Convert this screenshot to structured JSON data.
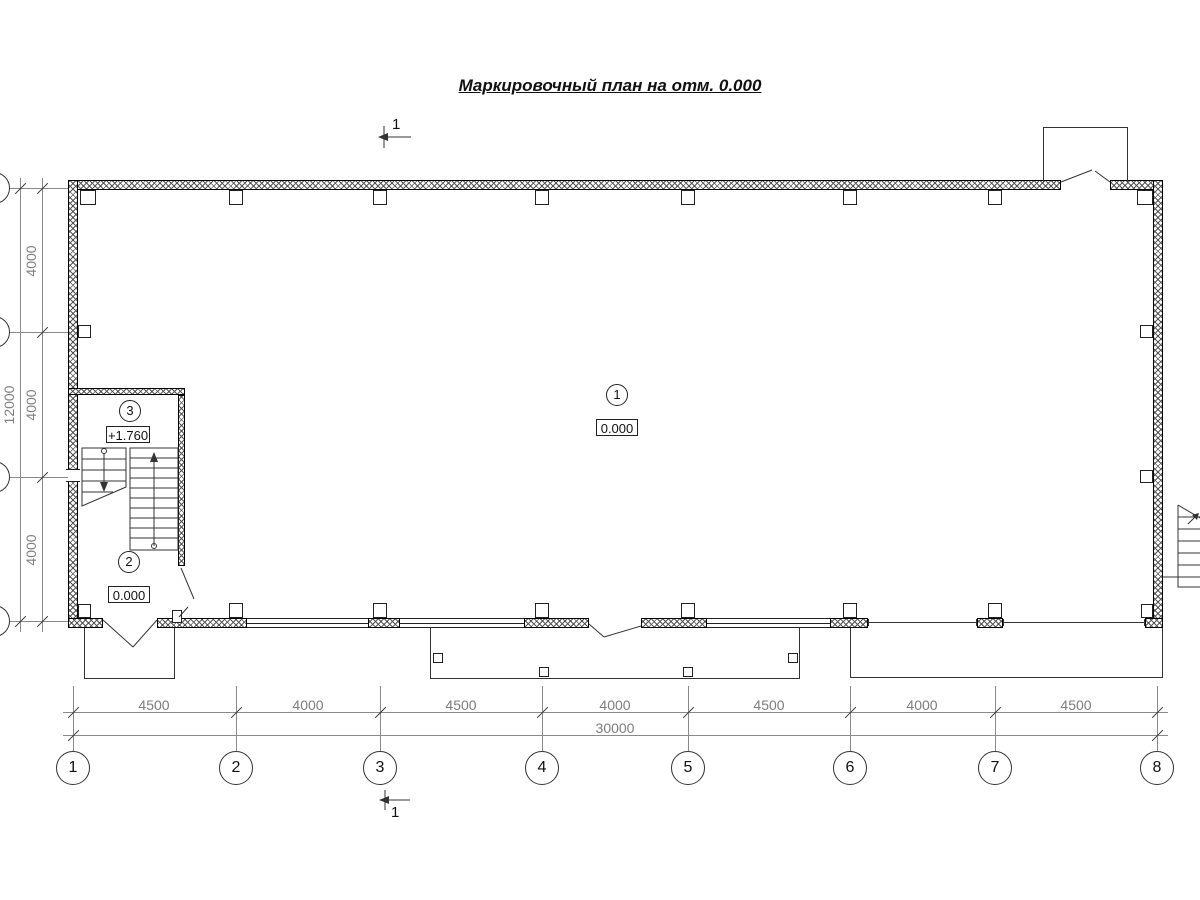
{
  "title": "Маркировочный план на отм. 0.000",
  "section_mark": {
    "label": "1"
  },
  "grid": {
    "columns": [
      "1",
      "2",
      "3",
      "4",
      "5",
      "6",
      "7",
      "8"
    ],
    "rows_visible": 4
  },
  "dimensions": {
    "bottom_segments": [
      "4500",
      "4000",
      "4500",
      "4000",
      "4500",
      "4000",
      "4500"
    ],
    "bottom_total": "30000",
    "left_segments": [
      "4000",
      "4000",
      "4000"
    ],
    "left_total": "12000"
  },
  "rooms": [
    {
      "number": "1",
      "elevation": "0.000"
    },
    {
      "number": "2",
      "elevation": "0.000"
    },
    {
      "number": "3",
      "elevation": "+1.760"
    }
  ],
  "colors": {
    "background": "#ffffff",
    "wall_line": "#000000",
    "drawing_line": "#333333",
    "dimension_line": "#8a8a8a",
    "dimension_text": "#7d7d7d"
  }
}
